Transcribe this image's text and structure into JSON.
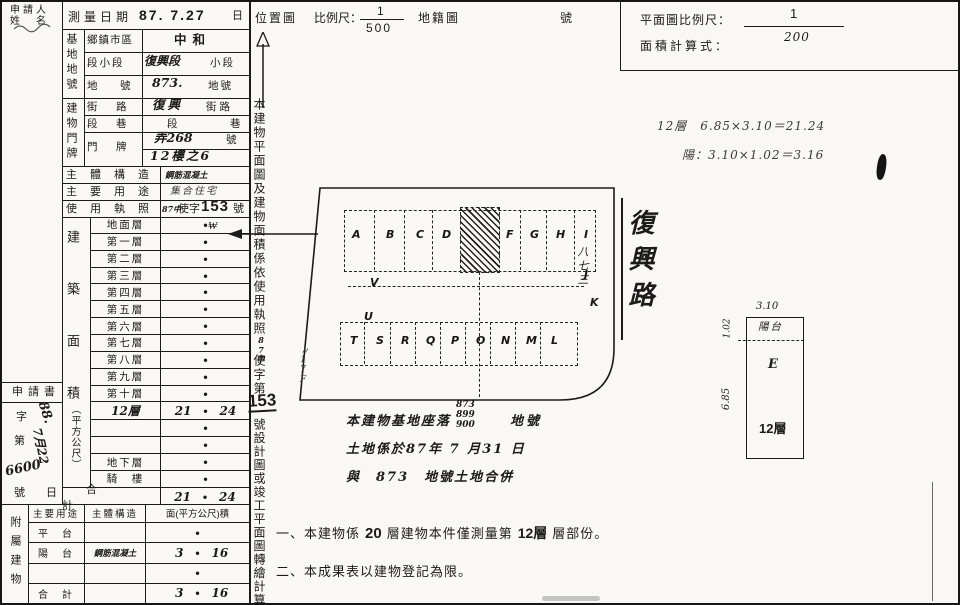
{
  "paper": {
    "bg": "#f9f8f4",
    "ink": "#1b1b1b"
  },
  "header": {
    "applicant_line1": "申請人",
    "applicant_line2": "姓　名",
    "survey_label": "測量日期",
    "survey_value": "87. 7.27",
    "day": "日",
    "loc_map": "位置圖",
    "scale_label": "比例尺：",
    "scale_num": "1",
    "scale_den": "500",
    "cad_map": "地籍圖",
    "no_suffix": "號",
    "plan_scale_label": "平面圖比例尺：",
    "plan_scale_num": "1",
    "plan_scale_den": "200",
    "formula_label": "面積計算式："
  },
  "site": {
    "group": "基地地號",
    "r1_label": "鄉鎮市區",
    "r1_value": "中和",
    "r2_label": "段小段",
    "r2_value": "復興段",
    "r2_suffix": "小段",
    "r3_label": "地　號",
    "r3_value": "873.",
    "r3_suffix": "地號"
  },
  "addr": {
    "group": "建物門牌",
    "r1_label": "街　路",
    "r1_value": "復興",
    "r1_suffix": "街路",
    "r2_label": "段　巷",
    "r2_d1": "段",
    "r2_d2": "巷",
    "r3_label": "門　牌",
    "r3_line1": "弄268",
    "r3_line1_suffix": "號",
    "r3_line2": "12樓之6"
  },
  "build": {
    "structure_label": "主體構造",
    "structure_value": "鋼筋混凝土",
    "usage_label": "主要用途",
    "usage_value": "集合住宅",
    "license_label": "使用執照",
    "license_hw": "87中",
    "license_mid": "使字",
    "license_num": "153",
    "license_suffix": "號",
    "area_label_main": "建築面積",
    "area_label_unit": "（平方公尺）",
    "floors": [
      {
        "name": "地面層"
      },
      {
        "name": "第一層"
      },
      {
        "name": "第二層"
      },
      {
        "name": "第三層"
      },
      {
        "name": "第四層"
      },
      {
        "name": "第五層"
      },
      {
        "name": "第六層"
      },
      {
        "name": "第七層"
      },
      {
        "name": "第八層"
      },
      {
        "name": "第九層"
      },
      {
        "name": "第十層"
      },
      {
        "name": "12層",
        "v1": "21",
        "v2": "24"
      },
      {
        "name": ""
      },
      {
        "name": ""
      },
      {
        "name": "地下層"
      },
      {
        "name": "騎　樓"
      }
    ],
    "total_label": "合　計",
    "total_v1": "21",
    "total_v2": "24"
  },
  "application": {
    "title": "申請書",
    "zi": "字",
    "di": "第",
    "number": "6600",
    "hao": "號",
    "date1": "88.",
    "date2": "7月22",
    "ri": "日"
  },
  "annex": {
    "group": "附屬建物",
    "h1": "主要用途",
    "h2": "主體構造",
    "h3": "面(平方公尺)積",
    "rows": [
      {
        "use": "平　台",
        "struct": "",
        "v1": "",
        "v2": ""
      },
      {
        "use": "陽　台",
        "struct": "鋼筋混凝土",
        "v1": "3",
        "v2": "16"
      },
      {
        "use": "",
        "struct": "",
        "v1": "",
        "v2": ""
      },
      {
        "use": "合　計",
        "struct": "",
        "v1": "3",
        "v2": "16"
      }
    ]
  },
  "strip": {
    "p1": "本建物平面圖及建物面積係依使用執照",
    "hw": "87中",
    "p2": "使字第",
    "num": "153",
    "p3": "號設計圖或竣工平面圖轉繪計算"
  },
  "sketch": {
    "letters_top_left": [
      "A",
      "B",
      "C",
      "D"
    ],
    "letters_top_right": [
      "F",
      "G",
      "H",
      "I"
    ],
    "letters_mid": [
      "V",
      "J",
      "U",
      "K"
    ],
    "letters_bottom": [
      "T",
      "S",
      "R",
      "Q",
      "P",
      "O",
      "N",
      "M",
      "L"
    ],
    "road": "復興路",
    "parcel": "八七三",
    "margin_note": "〃17F",
    "check_mark": "₩"
  },
  "site_note": {
    "l1": "本建物基地座落",
    "stack": [
      "873",
      "899",
      "900"
    ],
    "l1s": "地號",
    "l2": "土地係於87年 7 月31 日",
    "l3": "與　873　地號土地合併"
  },
  "calc": {
    "l1": "12層　6.85×3.10＝21.24",
    "l2": "陽：3.10×1.02＝3.16"
  },
  "detail": {
    "dim_top": "3.10",
    "dim_upper": "1.02",
    "dim_side": "6.85",
    "balcony": "陽台",
    "letter": "E",
    "floor": "12層"
  },
  "notes": {
    "n1a": "一、本建物係",
    "n1b": "20",
    "n1c": "層建物本件僅測量第",
    "n1d": "12層",
    "n1e": "層部份。",
    "n2": "二、本成果表以建物登記為限。"
  },
  "marks": {
    "dot": "●"
  }
}
